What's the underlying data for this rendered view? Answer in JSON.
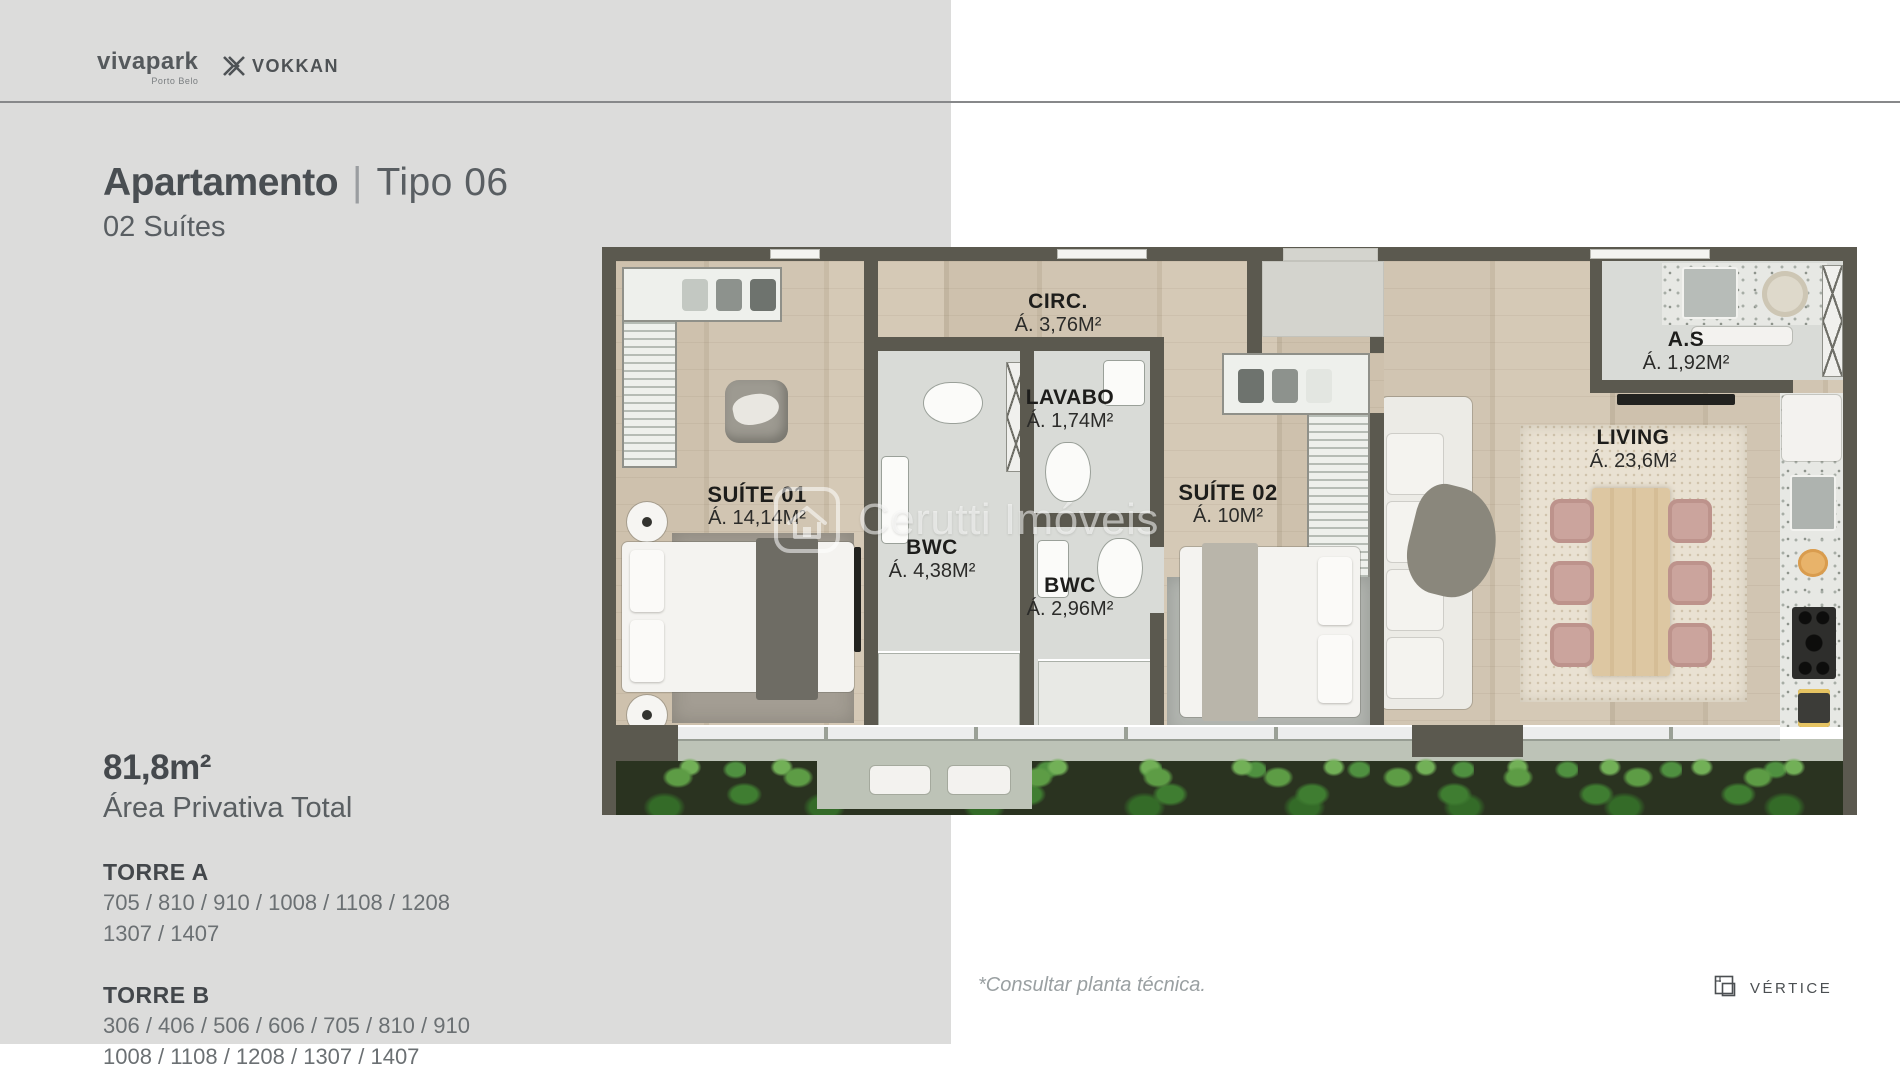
{
  "header": {
    "brand_primary": {
      "name": "vivapark",
      "sub": "Porto Belo"
    },
    "brand_secondary": "VOKKAN"
  },
  "title": {
    "main": "Apartamento",
    "separator": "|",
    "variant": "Tipo 06",
    "subtitle": "02 Suítes"
  },
  "details": {
    "area_value": "81,8m²",
    "area_label": "Área Privativa Total",
    "towers": [
      {
        "name": "TORRE A",
        "lines": [
          "705 / 810 / 910 / 1008 / 1108 / 1208",
          "1307 / 1407"
        ]
      },
      {
        "name": "TORRE B",
        "lines": [
          "306 / 406 / 506 / 606 / 705 / 810 / 910",
          "1008 / 1108 / 1208 / 1307 / 1407"
        ]
      }
    ]
  },
  "floor_plan": {
    "rooms": [
      {
        "name": "CIRC.",
        "area": "Á. 3,76M²"
      },
      {
        "name": "LAVABO",
        "area": "Á. 1,74M²"
      },
      {
        "name": "A.S",
        "area": "Á. 1,92M²"
      },
      {
        "name": "SUÍTE 01",
        "area": "Á. 14,14M²"
      },
      {
        "name": "BWC",
        "area": "Á. 4,38M²"
      },
      {
        "name": "BWC",
        "area": "Á. 2,96M²"
      },
      {
        "name": "SUÍTE 02",
        "area": "Á. 10M²"
      },
      {
        "name": "LIVING",
        "area": "Á. 23,6M²"
      }
    ],
    "watermark": "Cerutti Imóveis",
    "colors": {
      "wall": "#5b594f",
      "wood": "#cdc0ac",
      "accent_plant": "#4f9040"
    }
  },
  "footer": {
    "note": "*Consultar planta técnica.",
    "logo": "VÉRTICE"
  }
}
